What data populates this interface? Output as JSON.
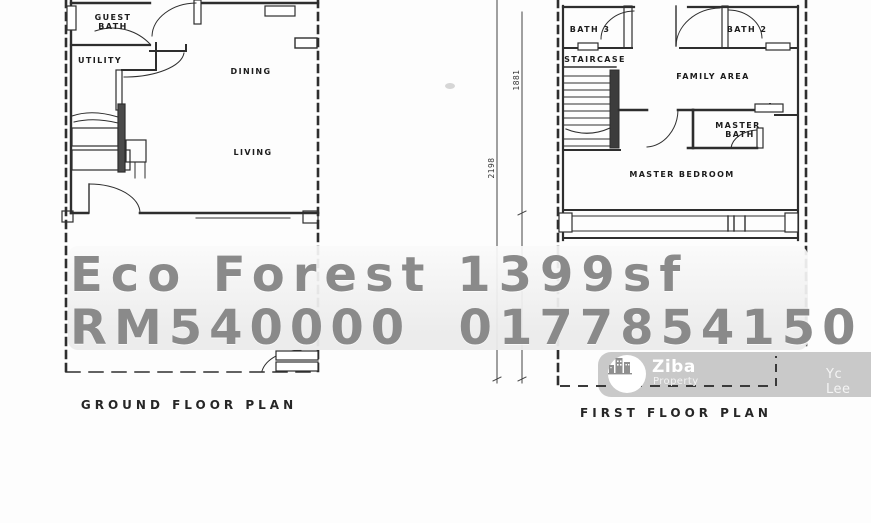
{
  "overlay": {
    "line1": "Eco Forest 1399sf",
    "line2": "RM540000  0177854150",
    "text_color": "#8a8a8a"
  },
  "ground_floor": {
    "caption": "GROUND FLOOR PLAN",
    "rooms": {
      "guest_bath_1": "GUEST",
      "guest_bath_2": "BATH",
      "utility": "UTILITY",
      "dining": "DINING",
      "living": "LIVING"
    }
  },
  "first_floor": {
    "caption": "FIRST FLOOR PLAN",
    "rooms": {
      "bath3": "BATH 3",
      "bath2": "BATH 2",
      "staircase": "STAIRCASE",
      "family_area": "FAMILY AREA",
      "master_bath_1": "MASTER",
      "master_bath_2": "BATH",
      "master_bedroom": "MASTER BEDROOM"
    }
  },
  "dimensions": {
    "left_line": "2198",
    "right_line": "1881"
  },
  "watermark": {
    "brand": "Ziba",
    "brand_sub": "Property",
    "agent": "Yc Lee",
    "bg_color": "#c7c7c7"
  },
  "colors": {
    "plan_line": "#2e2e2e",
    "background": "#fdfdfd"
  }
}
